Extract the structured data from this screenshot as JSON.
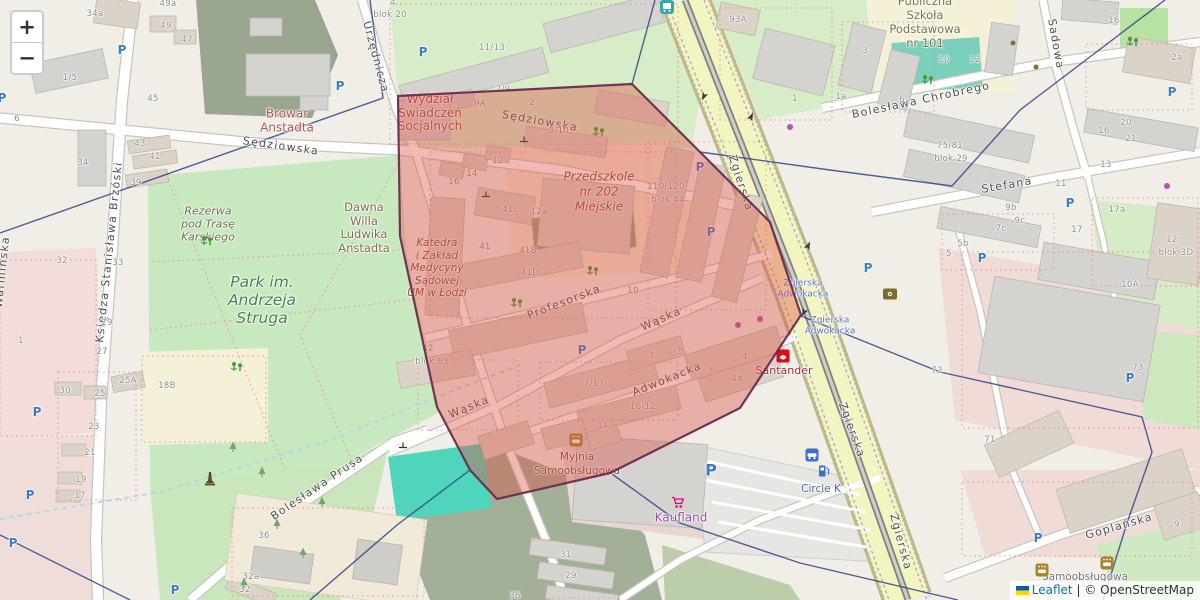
{
  "controls": {
    "zoom_in": "+",
    "zoom_out": "−"
  },
  "attribution": {
    "leaflet": "Leaflet",
    "separator": "|",
    "copyright": "© OpenStreetMap"
  },
  "theme": {
    "polygon_fill": "#dd4f44",
    "polygon_stroke": "#6d2b50",
    "boundary_line": "#2f4788",
    "road_major": "#f3f5c0",
    "park_green": "#c8e9c0",
    "forest_green": "#a2b098",
    "pool_teal": "#4fd5bc",
    "link_blue": "#0078A8",
    "parking_blue": "#3f7cc4"
  },
  "map": {
    "street_labels": [
      {
        "t": "Sędziowska",
        "x": 281,
        "y": 146,
        "r": 8
      },
      {
        "t": "Sędziowska",
        "x": 540,
        "y": 121,
        "r": 10
      },
      {
        "t": "Urzędnicza",
        "x": 376,
        "y": 57,
        "r": 75
      },
      {
        "t": "Zgierska",
        "x": 741,
        "y": 183,
        "r": 72
      },
      {
        "t": "Zgierska",
        "x": 852,
        "y": 430,
        "r": 70
      },
      {
        "t": "Zgierska",
        "x": 901,
        "y": 542,
        "r": 75
      },
      {
        "t": "Bolesława Chrobrego",
        "x": 921,
        "y": 100,
        "r": -12
      },
      {
        "t": "Sadowa",
        "x": 1056,
        "y": 44,
        "r": 80
      },
      {
        "t": "Stefana",
        "x": 1007,
        "y": 185,
        "r": -10
      },
      {
        "t": "Księdza Stanisława Brzóski",
        "x": 109,
        "y": 252,
        "r": -84
      },
      {
        "t": "Warmińska",
        "x": 2,
        "y": 272,
        "r": -84
      },
      {
        "t": "Bolesława Prusa",
        "x": 317,
        "y": 487,
        "r": -34
      },
      {
        "t": "Wąska",
        "x": 469,
        "y": 407,
        "r": -22
      },
      {
        "t": "Wąska",
        "x": 661,
        "y": 319,
        "r": -24
      },
      {
        "t": "Profesorska",
        "x": 564,
        "y": 302,
        "r": -21
      },
      {
        "t": "Adwokacka",
        "x": 667,
        "y": 379,
        "r": -22
      },
      {
        "t": "Goplańska",
        "x": 1119,
        "y": 526,
        "r": -16
      }
    ],
    "poi_labels": [
      {
        "id": "wydzial",
        "lines": [
          "Wydział",
          "Świadczeń",
          "Socjalnych"
        ],
        "x": 430,
        "y": 113,
        "fs": 12,
        "lh": 13.5,
        "c": "#9f4a41",
        "i": false
      },
      {
        "id": "browar",
        "lines": [
          "Browar",
          "Anstadta"
        ],
        "x": 287,
        "y": 121,
        "fs": 12,
        "lh": 13.5,
        "c": "#b1574f",
        "i": false
      },
      {
        "id": "przedszkole",
        "lines": [
          "Przedszkole",
          "nr 202",
          "Miejskie"
        ],
        "x": 599,
        "y": 192,
        "fs": 12,
        "lh": 15,
        "c": "#8a4c3a",
        "i": true
      },
      {
        "id": "katedra",
        "lines": [
          "Katedra",
          "i Zakład",
          "Medycyny",
          "Sądowej",
          "UM w Łodzi"
        ],
        "x": 437,
        "y": 268,
        "fs": 10.5,
        "lh": 12.5,
        "c": "#8a4a3e",
        "i": true
      },
      {
        "id": "dawna-willa",
        "lines": [
          "Dawna",
          "Willa",
          "Ludwika",
          "Anstadta"
        ],
        "x": 364,
        "y": 228,
        "fs": 11.5,
        "lh": 13.5,
        "c": "#7d6b53",
        "i": false
      },
      {
        "id": "park-struga",
        "lines": [
          "Park im.",
          "Andrzeja",
          "Struga"
        ],
        "x": 262,
        "y": 300,
        "fs": 15.5,
        "lh": 18,
        "c": "#4c7d52",
        "i": true
      },
      {
        "id": "rezerwa",
        "lines": [
          "Rezerwa",
          "pod Trasę",
          "Karskiego"
        ],
        "x": 208,
        "y": 224,
        "fs": 11,
        "lh": 13,
        "c": "#6c6c50",
        "i": true
      },
      {
        "id": "szkola-101",
        "lines": [
          "Publiczna",
          "Szkoła",
          "Podstawowa",
          "nr 101"
        ],
        "x": 925,
        "y": 22,
        "fs": 11.5,
        "lh": 14,
        "c": "#787052",
        "i": false
      },
      {
        "id": "myjnia",
        "lines": [
          "Myjnia",
          "Samoobsługowa"
        ],
        "x": 577,
        "y": 464,
        "fs": 10.5,
        "lh": 14,
        "c": "#6e5147",
        "i": false
      },
      {
        "id": "myjnia2",
        "lines": [
          "Samoobsługowa"
        ],
        "x": 1085,
        "y": 577,
        "fs": 10.5,
        "lh": 12,
        "c": "#757575",
        "i": false
      },
      {
        "id": "kaufland",
        "lines": [
          "Kaufland"
        ],
        "x": 681,
        "y": 518,
        "fs": 12,
        "lh": 13,
        "c": "#96519b",
        "i": false
      },
      {
        "id": "santander",
        "lines": [
          "Santander"
        ],
        "x": 784,
        "y": 371,
        "fs": 11,
        "lh": 12,
        "c": "#9c2f38",
        "i": false
      },
      {
        "id": "circle-k",
        "lines": [
          "Circle K"
        ],
        "x": 821,
        "y": 489,
        "fs": 10.5,
        "lh": 12,
        "c": "#4d66b3",
        "i": false
      }
    ],
    "transit_labels": [
      {
        "lines": [
          "Zgierska",
          "Adwokacka"
        ],
        "x": 803,
        "y": 289
      },
      {
        "lines": [
          "Zgierska",
          "Adwokacka"
        ],
        "x": 830,
        "y": 326
      }
    ],
    "house_numbers": [
      {
        "t": "49a",
        "x": 168,
        "y": 4
      },
      {
        "t": "49",
        "x": 166,
        "y": 26
      },
      {
        "t": "47",
        "x": 187,
        "y": 40
      },
      {
        "t": "45",
        "x": 153,
        "y": 99
      },
      {
        "t": "43",
        "x": 140,
        "y": 144
      },
      {
        "t": "41",
        "x": 155,
        "y": 157
      },
      {
        "t": "39",
        "x": 136,
        "y": 183
      },
      {
        "t": "34a",
        "x": 95,
        "y": 14
      },
      {
        "t": "34",
        "x": 83,
        "y": 163
      },
      {
        "t": "1/5",
        "x": 70,
        "y": 78
      },
      {
        "t": "6",
        "x": 17,
        "y": 119
      },
      {
        "t": "32",
        "x": 62,
        "y": 261
      },
      {
        "t": "1",
        "x": 21,
        "y": 341
      },
      {
        "t": "29",
        "x": 107,
        "y": 323
      },
      {
        "t": "27",
        "x": 102,
        "y": 352
      },
      {
        "t": "33",
        "x": 118,
        "y": 263
      },
      {
        "t": "4",
        "x": 393,
        "y": 3
      },
      {
        "t": "blok 20",
        "x": 390,
        "y": 15
      },
      {
        "t": "11/13",
        "x": 492,
        "y": 48
      },
      {
        "t": "7/9",
        "x": 503,
        "y": 90
      },
      {
        "t": "9A",
        "x": 480,
        "y": 104
      },
      {
        "t": "2",
        "x": 532,
        "y": 103
      },
      {
        "t": "8/10",
        "x": 559,
        "y": 131
      },
      {
        "t": "12",
        "x": 498,
        "y": 161
      },
      {
        "t": "14",
        "x": 472,
        "y": 174
      },
      {
        "t": "16",
        "x": 454,
        "y": 182
      },
      {
        "t": "41C",
        "x": 511,
        "y": 210
      },
      {
        "t": "12a",
        "x": 539,
        "y": 212
      },
      {
        "t": "110/120",
        "x": 666,
        "y": 187
      },
      {
        "t": "blok 44",
        "x": 668,
        "y": 200
      },
      {
        "t": "41",
        "x": 485,
        "y": 247
      },
      {
        "t": "41B",
        "x": 528,
        "y": 251
      },
      {
        "t": "41D",
        "x": 530,
        "y": 273
      },
      {
        "t": "42",
        "x": 428,
        "y": 349
      },
      {
        "t": "blok 63",
        "x": 432,
        "y": 362
      },
      {
        "t": "10",
        "x": 633,
        "y": 291
      },
      {
        "t": "7",
        "x": 652,
        "y": 357
      },
      {
        "t": "5",
        "x": 681,
        "y": 352
      },
      {
        "t": "7/13",
        "x": 594,
        "y": 384
      },
      {
        "t": "10/12",
        "x": 643,
        "y": 407
      },
      {
        "t": "14",
        "x": 603,
        "y": 426
      },
      {
        "t": "93A",
        "x": 738,
        "y": 20
      },
      {
        "t": "3",
        "x": 865,
        "y": 51
      },
      {
        "t": "1",
        "x": 795,
        "y": 99
      },
      {
        "t": "1a",
        "x": 841,
        "y": 97
      },
      {
        "t": "6",
        "x": 902,
        "y": 100
      },
      {
        "t": "10",
        "x": 944,
        "y": 60
      },
      {
        "t": "12",
        "x": 975,
        "y": 60
      },
      {
        "t": "16",
        "x": 1114,
        "y": 21
      },
      {
        "t": "2a",
        "x": 1177,
        "y": 58
      },
      {
        "t": "75/81",
        "x": 950,
        "y": 146
      },
      {
        "t": "blok 29",
        "x": 951,
        "y": 159
      },
      {
        "t": "16",
        "x": 1104,
        "y": 131
      },
      {
        "t": "20",
        "x": 1126,
        "y": 123
      },
      {
        "t": "21",
        "x": 1131,
        "y": 139
      },
      {
        "t": "13",
        "x": 1106,
        "y": 165
      },
      {
        "t": "11",
        "x": 1061,
        "y": 184
      },
      {
        "t": "9b",
        "x": 1011,
        "y": 208
      },
      {
        "t": "9c",
        "x": 1020,
        "y": 221
      },
      {
        "t": "7c",
        "x": 1001,
        "y": 229
      },
      {
        "t": "5b",
        "x": 963,
        "y": 244
      },
      {
        "t": "5",
        "x": 949,
        "y": 254
      },
      {
        "t": "17a",
        "x": 1117,
        "y": 210
      },
      {
        "t": "17",
        "x": 1077,
        "y": 230
      },
      {
        "t": "12",
        "x": 1172,
        "y": 240
      },
      {
        "t": "blok 3D",
        "x": 1176,
        "y": 253
      },
      {
        "t": "10A",
        "x": 1130,
        "y": 285
      },
      {
        "t": "73",
        "x": 937,
        "y": 371
      },
      {
        "t": "73",
        "x": 1138,
        "y": 368
      },
      {
        "t": "71",
        "x": 990,
        "y": 440
      },
      {
        "t": "9",
        "x": 1177,
        "y": 525
      },
      {
        "t": "30",
        "x": 65,
        "y": 391
      },
      {
        "t": "25A",
        "x": 128,
        "y": 381
      },
      {
        "t": "25",
        "x": 100,
        "y": 394
      },
      {
        "t": "23",
        "x": 94,
        "y": 427
      },
      {
        "t": "21",
        "x": 90,
        "y": 453
      },
      {
        "t": "19",
        "x": 81,
        "y": 480
      },
      {
        "t": "17",
        "x": 80,
        "y": 496
      },
      {
        "t": "18B",
        "x": 167,
        "y": 386
      },
      {
        "t": "36",
        "x": 264,
        "y": 536
      },
      {
        "t": "32a",
        "x": 251,
        "y": 577
      },
      {
        "t": "32",
        "x": 245,
        "y": 590
      },
      {
        "t": "31",
        "x": 566,
        "y": 555
      },
      {
        "t": "29",
        "x": 571,
        "y": 576
      },
      {
        "t": "36",
        "x": 515,
        "y": 596
      },
      {
        "t": "4",
        "x": 745,
        "y": 357
      },
      {
        "t": "4a",
        "x": 737,
        "y": 379
      },
      {
        "t": "6",
        "x": 712,
        "y": 371
      }
    ],
    "parking": [
      {
        "x": 2,
        "y": 98
      },
      {
        "x": 122,
        "y": 50
      },
      {
        "x": 340,
        "y": 86
      },
      {
        "x": 423,
        "y": 52
      },
      {
        "x": 700,
        "y": 167
      },
      {
        "x": 711,
        "y": 232
      },
      {
        "x": 868,
        "y": 268
      },
      {
        "x": 1172,
        "y": 92
      },
      {
        "x": 1070,
        "y": 203
      },
      {
        "x": 982,
        "y": 258
      },
      {
        "x": 1130,
        "y": 378
      },
      {
        "x": 1038,
        "y": 538
      },
      {
        "x": 37,
        "y": 412
      },
      {
        "x": 30,
        "y": 495
      },
      {
        "x": 13,
        "y": 543
      },
      {
        "x": 175,
        "y": 590
      },
      {
        "x": 711,
        "y": 470,
        "s": 16
      },
      {
        "x": 582,
        "y": 350
      }
    ],
    "icons": [
      {
        "k": "playground",
        "x": 207,
        "y": 241
      },
      {
        "k": "playground",
        "x": 237,
        "y": 367
      },
      {
        "k": "playground",
        "x": 517,
        "y": 303
      },
      {
        "k": "playground",
        "x": 593,
        "y": 271
      },
      {
        "k": "playground",
        "x": 599,
        "y": 132
      },
      {
        "k": "playground",
        "x": 928,
        "y": 80
      },
      {
        "k": "playground",
        "x": 1133,
        "y": 42
      },
      {
        "k": "carwash",
        "x": 576,
        "y": 440
      },
      {
        "k": "carwash",
        "x": 1042,
        "y": 570
      },
      {
        "k": "carwash",
        "x": 1107,
        "y": 563
      },
      {
        "k": "monument",
        "x": 210,
        "y": 479
      },
      {
        "k": "santander-logo",
        "x": 783,
        "y": 356
      },
      {
        "k": "kaufland-cart",
        "x": 678,
        "y": 503
      },
      {
        "k": "circlek-car",
        "x": 812,
        "y": 455
      },
      {
        "k": "fuel-pump",
        "x": 824,
        "y": 471
      },
      {
        "k": "transit-stop",
        "x": 667,
        "y": 7
      },
      {
        "k": "shop-dot",
        "x": 738,
        "y": 325
      },
      {
        "k": "shop-dot",
        "x": 760,
        "y": 319
      },
      {
        "k": "shop-dot",
        "x": 790,
        "y": 127
      },
      {
        "k": "shop-dot",
        "x": 1167,
        "y": 186
      },
      {
        "k": "cafe-dot",
        "x": 1013,
        "y": 43
      },
      {
        "k": "cafe-dot",
        "x": 1036,
        "y": 67
      },
      {
        "k": "poi-box",
        "x": 890,
        "y": 294
      },
      {
        "k": "tree",
        "x": 233,
        "y": 447
      },
      {
        "k": "tree",
        "x": 262,
        "y": 472
      },
      {
        "k": "tree",
        "x": 277,
        "y": 524
      },
      {
        "k": "tree",
        "x": 322,
        "y": 502
      },
      {
        "k": "tree",
        "x": 303,
        "y": 553
      },
      {
        "k": "tree",
        "x": 244,
        "y": 583
      },
      {
        "k": "arrow",
        "x": 704,
        "y": 96,
        "r": 205
      },
      {
        "k": "arrow",
        "x": 751,
        "y": 117,
        "r": 25
      },
      {
        "k": "arrow",
        "x": 808,
        "y": 246,
        "r": 25
      },
      {
        "k": "arrow",
        "x": 804,
        "y": 312,
        "r": 205
      },
      {
        "k": "gate",
        "x": 524,
        "y": 139
      },
      {
        "k": "gate",
        "x": 486,
        "y": 194
      },
      {
        "k": "gate",
        "x": 403,
        "y": 445
      }
    ]
  }
}
